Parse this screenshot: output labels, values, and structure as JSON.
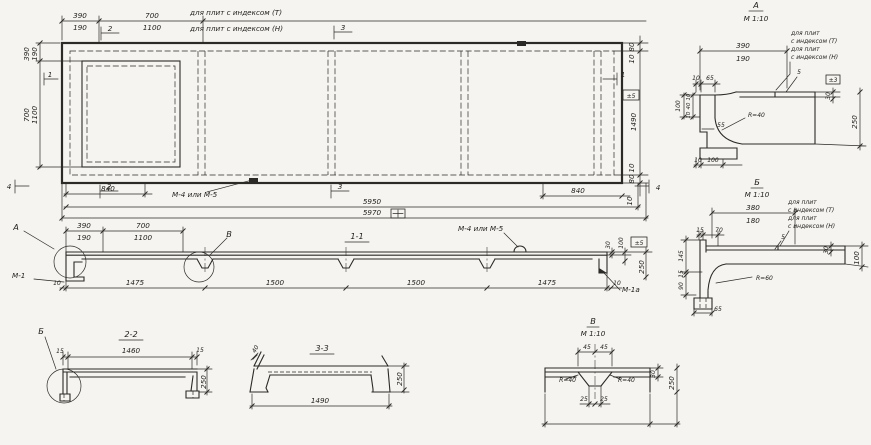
{
  "meta": {
    "paper_color": "#f5f4f0",
    "ink_color": "#2b2a27"
  },
  "notes": {
    "index_t": "для плит с индексом (Т)",
    "index_n": "для плит с индексом (Н)",
    "for_plates": "для плит",
    "idx_t": "с индексом (Т)",
    "idx_n": "с индексом (Н)",
    "loop": "М-4 или М-5",
    "m1": "М-1",
    "m1a": "М-1а"
  },
  "flags": {
    "f1": "1",
    "f2": "2",
    "f3": "3",
    "f4": "4"
  },
  "tol": {
    "pm5": "±5",
    "pm3": "±3"
  },
  "icons": {
    "tol_box": "squared-plus-tolerance-icon",
    "loop_mark": "lifting-loop-icon"
  },
  "plan": {
    "d390": "390",
    "d190": "190",
    "d700": "700",
    "d1100": "1100",
    "d80": "80",
    "d10": "10",
    "d1490": "1490",
    "d840": "840",
    "d5950": "5950",
    "d5970": "5970"
  },
  "sec11": {
    "title": "1-1",
    "d390": "390",
    "d190": "190",
    "d700": "700",
    "d1100": "1100",
    "d10": "10",
    "d1475": "1475",
    "d1500": "1500",
    "d30": "30",
    "d100": "100",
    "d250": "250",
    "mark_a": "А",
    "mark_v": "В"
  },
  "sec22": {
    "title": "2-2",
    "mark_b": "Б",
    "d15": "15",
    "d1460": "1460",
    "d250": "250"
  },
  "sec33": {
    "title": "3-3",
    "d40": "40",
    "d1490": "1490",
    "d250": "250"
  },
  "detA": {
    "title": "А",
    "scale": "М 1:10",
    "d390": "390",
    "d190": "190",
    "d10": "10",
    "d65": "65",
    "d100": "100",
    "d40": "40",
    "d55": "55",
    "d5": "5",
    "r": "R=40",
    "d30": "30",
    "d250": "250"
  },
  "detB": {
    "title": "Б",
    "scale": "М 1:10",
    "d380": "380",
    "d180": "180",
    "d15": "15",
    "d70": "70",
    "d145": "145",
    "d90": "90",
    "d65": "65",
    "d5": "5",
    "r": "R=60",
    "d30": "30",
    "d100": "100"
  },
  "detV": {
    "title": "В",
    "scale": "М 1:10",
    "d45": "45",
    "d25": "25",
    "r": "R=40",
    "d30": "30",
    "d250": "250"
  }
}
